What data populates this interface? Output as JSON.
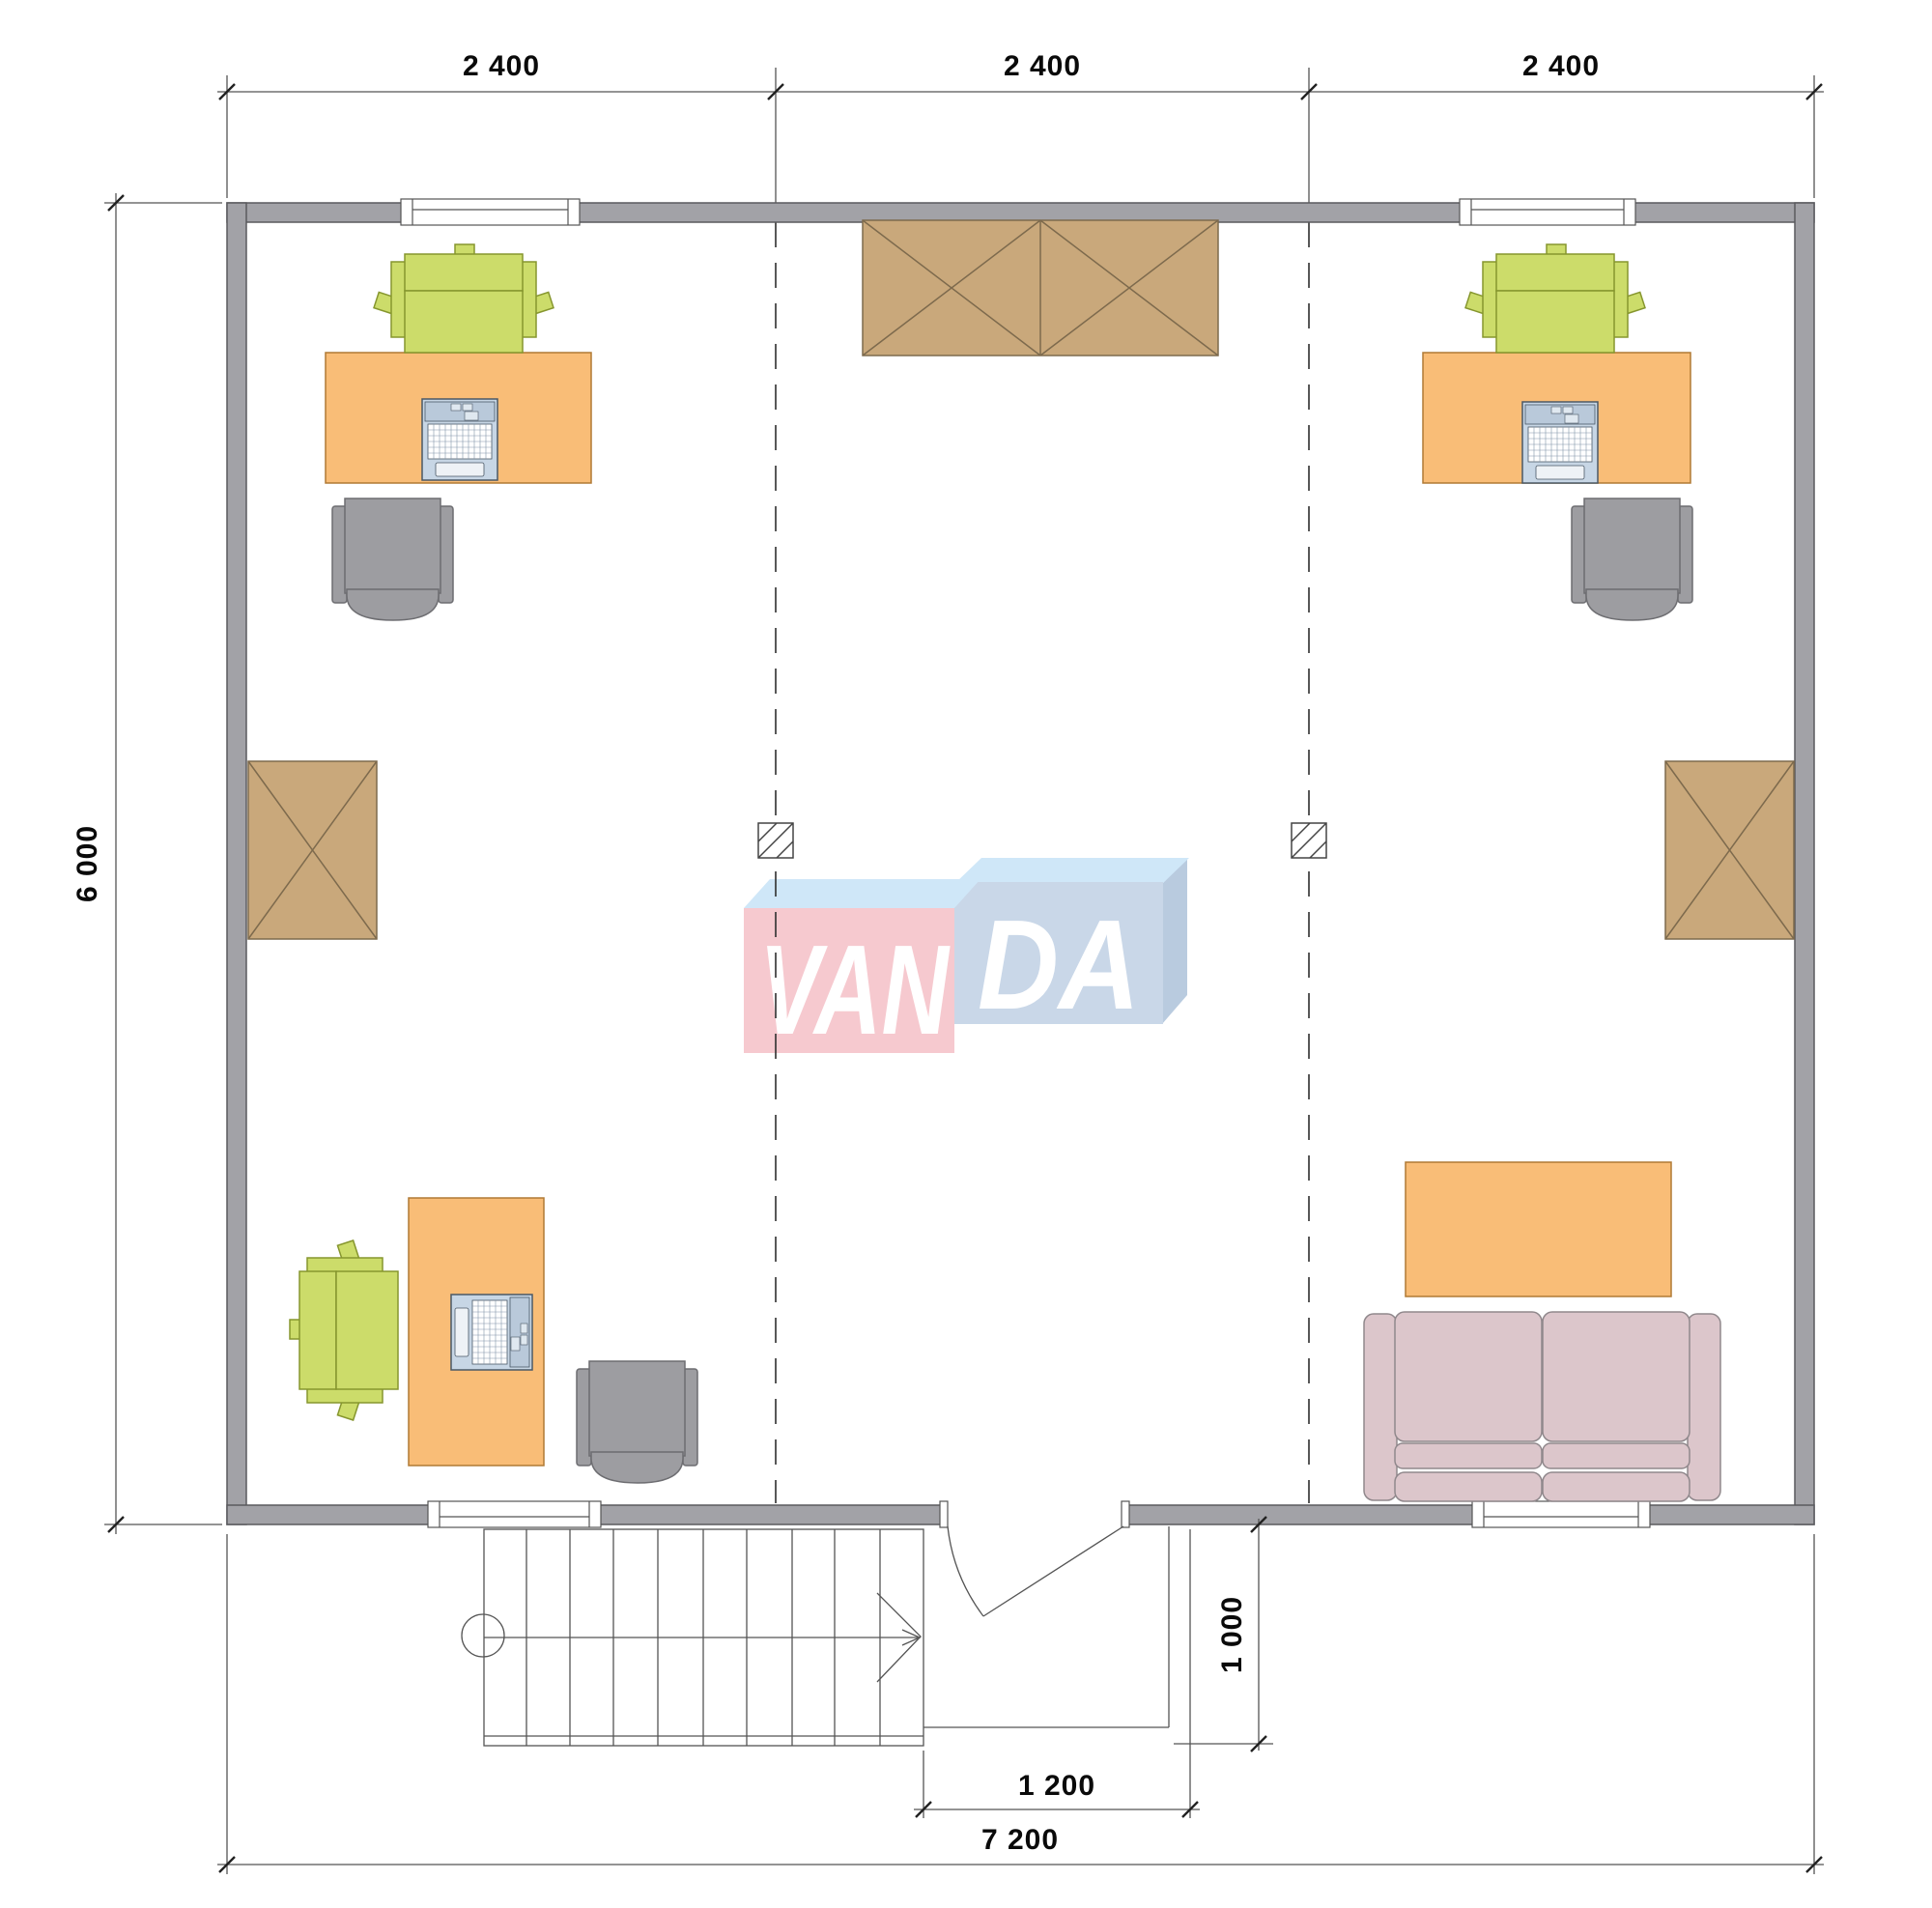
{
  "drawing": {
    "type": "floor-plan",
    "brand_watermark": "VANDA"
  },
  "dimensions": {
    "bays": [
      "2 400",
      "2 400",
      "2 400"
    ],
    "height": "6 000",
    "porch_depth": "1 000",
    "entry_width": "1 200",
    "total_width": "7 200"
  },
  "watermark": {
    "left": "VAN",
    "right": "DA"
  },
  "colors": {
    "wall": "#a2a2a7",
    "desk": "#f9bd77",
    "table": "#f9bd77",
    "chair_green": "#ccdc6a",
    "chair_gray": "#9d9da1",
    "sofa": "#dcc6cb",
    "cabinet": "#c9a87b",
    "laptop_body": "#c7d6e5",
    "logo_pink": "#f6c9cf",
    "logo_blue_front": "#c9d7e8",
    "logo_blue_top": "#cfe7f8",
    "logo_blue_side": "#b9cbdf"
  },
  "symbols": {
    "workstations": 3,
    "storage_boxes": 3,
    "columns": 2,
    "sofa": 1,
    "coffee_table": 1,
    "stairs": 1,
    "door": 1,
    "windows": 4
  }
}
